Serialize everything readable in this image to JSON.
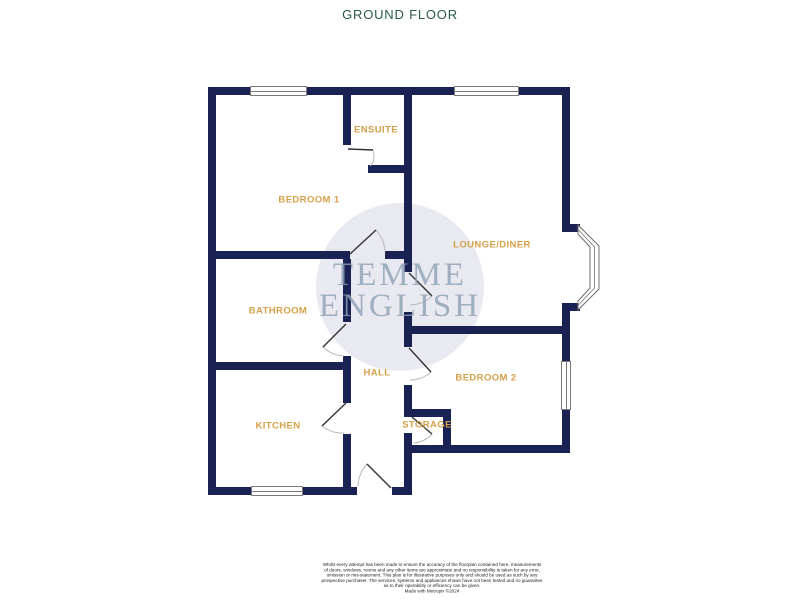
{
  "page": {
    "title": "GROUND FLOOR"
  },
  "watermark": {
    "line1": "TEMME",
    "line2": "ENGLISH"
  },
  "rooms": [
    {
      "id": "ensuite",
      "label": "ENSUITE"
    },
    {
      "id": "bedroom-1",
      "label": "BEDROOM 1"
    },
    {
      "id": "lounge-diner",
      "label": "LOUNGE/DINER"
    },
    {
      "id": "bathroom",
      "label": "BATHROOM"
    },
    {
      "id": "hall",
      "label": "HALL"
    },
    {
      "id": "bedroom-2",
      "label": "BEDROOM 2"
    },
    {
      "id": "kitchen",
      "label": "KITCHEN"
    },
    {
      "id": "storage",
      "label": "STORAGE"
    }
  ],
  "disclaimer": {
    "lines": [
      "Whilst every attempt has been made to ensure the accuracy of the floorplan contained here, measurements",
      "of doors, windows, rooms and any other items are approximate and no responsibility is taken for any error,",
      "omission or mis-statement. This plan is for illustrative purposes only and should be used as such by any",
      "prospective purchaser. The services, systems and appliances shown have not been tested and no guarantee",
      "as to their operability or efficiency can be given.",
      "Made with Metropix ©2024"
    ]
  },
  "colors": {
    "wall": "#1A2153",
    "label": "#D6A048",
    "title": "#2A5A49",
    "wm_text": "#8FA3B6",
    "wm_circle": "#E9E9F1"
  }
}
